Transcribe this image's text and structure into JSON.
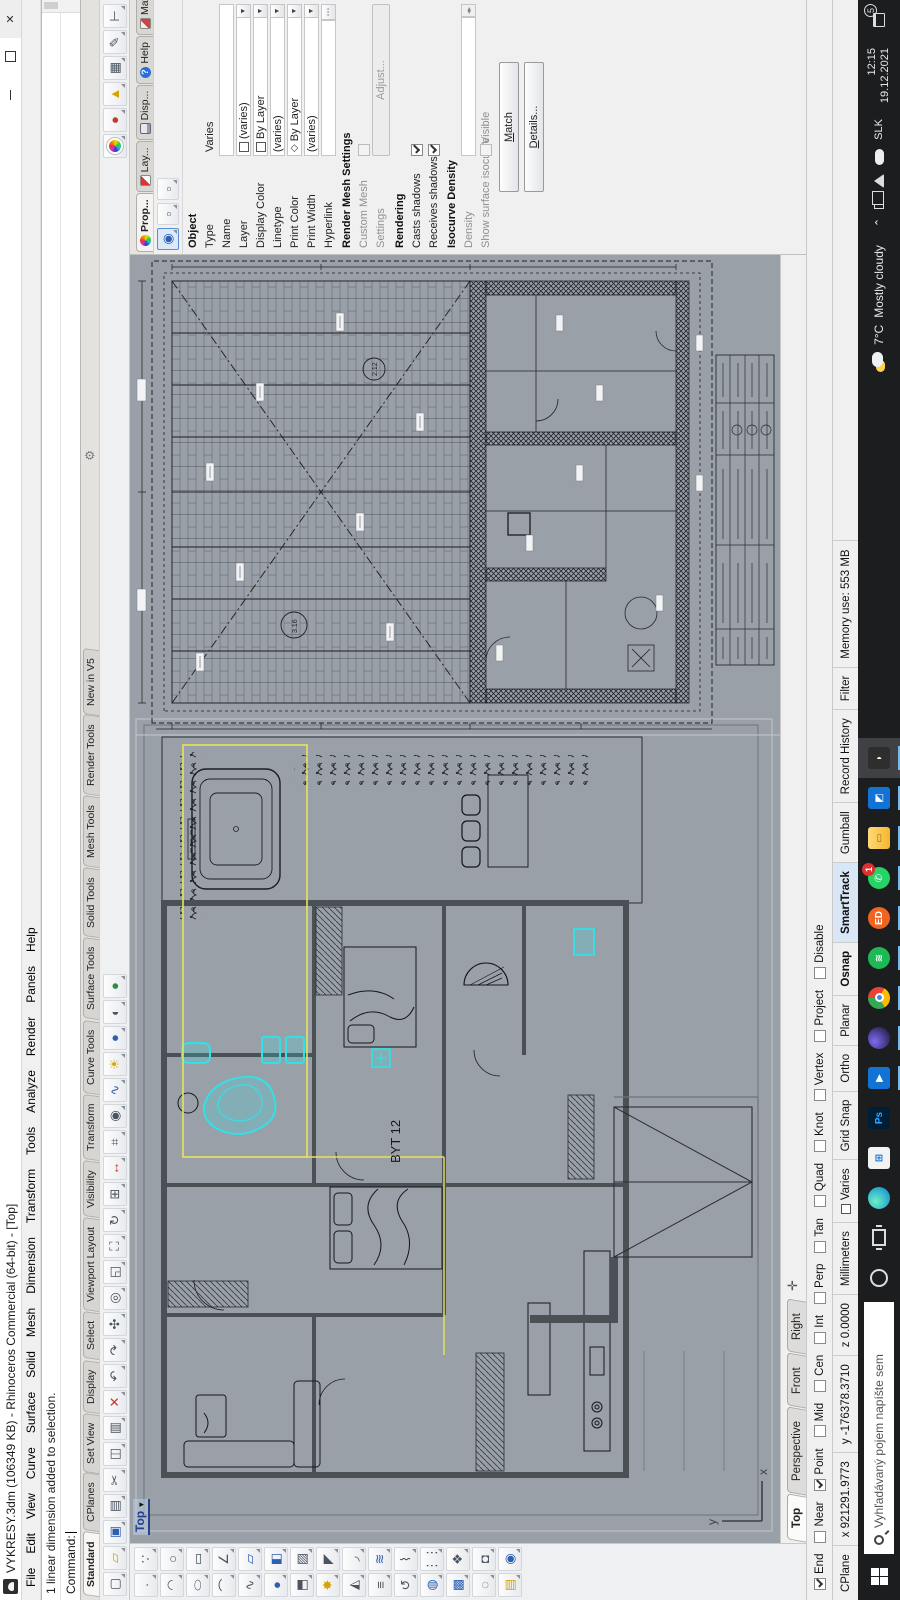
{
  "window": {
    "title": "VYKRESY.3dm (106349 KB) - Rhinoceros Commercial (64-bit) - [Top]",
    "controls": {
      "minimize": "minimize",
      "maximize": "maximize",
      "close": "close"
    }
  },
  "menu": [
    "File",
    "Edit",
    "View",
    "Curve",
    "Surface",
    "Solid",
    "Mesh",
    "Dimension",
    "Transform",
    "Tools",
    "Analyze",
    "Render",
    "Panels",
    "Help"
  ],
  "command": {
    "history": "1 linear dimension added to selection.",
    "prompt": "Command:"
  },
  "toolbar_tabs": {
    "active": "Standard",
    "items": [
      "Standard",
      "CPlanes",
      "Set View",
      "Display",
      "Select",
      "Viewport Layout",
      "Visibility",
      "Transform",
      "Curve Tools",
      "Surface Tools",
      "Solid Tools",
      "Mesh Tools",
      "Render Tools",
      "New in V5"
    ]
  },
  "toolbar_icons_left": [
    "new-file-icon",
    "open-file-icon",
    "save-icon",
    "print-icon",
    "cut-icon",
    "copy-icon",
    "paste-icon",
    "delete-icon",
    "undo-icon",
    "redo-icon",
    "pan-icon",
    "zoom-dynamic-icon",
    "zoom-window-icon",
    "zoom-extents-icon",
    "rotate-view-icon",
    "viewport-layout-icon",
    "move-icon",
    "cplane-icon",
    "osnap-icon",
    "analyze-icon",
    "light-icon",
    "shaded-view-icon",
    "ghosted-view-icon",
    "rendered-view-icon"
  ],
  "toolbar_icons_right": [
    "color-wheel-icon",
    "render-sphere-icon",
    "spotlight-icon",
    "grid-annotate-icon",
    "page-annotate-icon",
    "dimension-annotate-icon"
  ],
  "side_toolbar_icons": [
    "point-icon",
    "control-points-icon",
    "curve-icon",
    "circle-icon",
    "ellipse-icon",
    "rectangle-icon",
    "arc-icon",
    "polyline-icon",
    "freeform-curve-icon",
    "surface-icon",
    "sphere-icon",
    "box-icon",
    "extrude-icon",
    "patch-icon",
    "explode-icon",
    "trim-icon",
    "split-icon",
    "fillet-icon",
    "offset-icon",
    "loft-icon",
    "revolve-icon",
    "sweep-icon",
    "boolean-icon",
    "array-icon",
    "block-icon",
    "group-icon",
    "hide-icon",
    "lock-icon",
    "layer-state-icon",
    "object-properties-icon"
  ],
  "viewport": {
    "label": "Top",
    "axis_x": "x",
    "axis_y": "y",
    "plan_label": "BYT 12",
    "room_labels": [
      "3.16",
      "2.12"
    ]
  },
  "viewport_tabs": {
    "active": "Top",
    "items": [
      "Top",
      "Perspective",
      "Front",
      "Right"
    ],
    "add_button": "new-viewport-tab"
  },
  "properties_panel": {
    "active_tab": "Prop...",
    "tabs": [
      {
        "label": "Prop...",
        "icon": "color-wheel-icon"
      },
      {
        "label": "Lay...",
        "icon": "layers-icon"
      },
      {
        "label": "Disp...",
        "icon": "display-icon"
      },
      {
        "label": "Help",
        "icon": "help-icon"
      },
      {
        "label": "Mat...",
        "icon": "material-icon"
      }
    ],
    "subtoolbar": [
      "object-properties-icon",
      "material-icon",
      "dimension-style-icon"
    ],
    "groups": [
      {
        "header": "Object",
        "rows": [
          {
            "label": "Type",
            "value": "Varies",
            "kind": "text"
          },
          {
            "label": "Name",
            "value": "",
            "kind": "field"
          },
          {
            "label": "Layer",
            "value": "(varies)",
            "kind": "combo",
            "swatch": true
          },
          {
            "label": "Display Color",
            "value": "By Layer",
            "kind": "combo",
            "swatch": true
          },
          {
            "label": "Linetype",
            "value": "(varies)",
            "kind": "combo"
          },
          {
            "label": "Print Color",
            "value": "By Layer",
            "kind": "combo",
            "diamond": true
          },
          {
            "label": "Print Width",
            "value": "(varies)",
            "kind": "combo"
          },
          {
            "label": "Hyperlink",
            "value": "",
            "kind": "dots"
          }
        ]
      },
      {
        "header": "Render Mesh Settings",
        "rows": [
          {
            "label": "Custom Mesh",
            "kind": "checkbox",
            "checked": false,
            "disabled": true
          },
          {
            "label": "Settings",
            "kind": "button",
            "button": "Adjust...",
            "disabled": true
          }
        ]
      },
      {
        "header": "Rendering",
        "rows": [
          {
            "label": "Casts shadows",
            "kind": "checkbox",
            "checked": true
          },
          {
            "label": "Receives shadows",
            "kind": "checkbox",
            "checked": true
          }
        ]
      },
      {
        "header": "Isocurve Density",
        "rows": [
          {
            "label": "Density",
            "value": "",
            "kind": "spinner",
            "disabled": true
          },
          {
            "label": "Show surface isocurve",
            "value": "Visible",
            "kind": "checkbox2",
            "checked": false,
            "disabled": true
          }
        ]
      }
    ],
    "buttons": [
      "Match",
      "Details..."
    ]
  },
  "osnap": {
    "items": [
      {
        "label": "End",
        "checked": true
      },
      {
        "label": "Near",
        "checked": false
      },
      {
        "label": "Point",
        "checked": true
      },
      {
        "label": "Mid",
        "checked": false
      },
      {
        "label": "Cen",
        "checked": false
      },
      {
        "label": "Int",
        "checked": false
      },
      {
        "label": "Perp",
        "checked": false
      },
      {
        "label": "Tan",
        "checked": false
      },
      {
        "label": "Quad",
        "checked": false
      },
      {
        "label": "Knot",
        "checked": false
      },
      {
        "label": "Vertex",
        "checked": false
      },
      {
        "label": "Project",
        "checked": false
      },
      {
        "label": "Disable",
        "checked": false
      }
    ]
  },
  "statusbar": {
    "panes": [
      {
        "label": "CPlane"
      },
      {
        "label": "x 921291.9773"
      },
      {
        "label": "y -176378.3710"
      },
      {
        "label": "z 0.0000"
      },
      {
        "label": "Millimeters"
      },
      {
        "label": "Varies",
        "swatch": true
      },
      {
        "label": "Grid Snap"
      },
      {
        "label": "Ortho"
      },
      {
        "label": "Planar"
      },
      {
        "label": "Osnap",
        "bold": true
      },
      {
        "label": "SmartTrack",
        "bold": true,
        "highlight": true
      },
      {
        "label": "Gumball"
      },
      {
        "label": "Record History"
      },
      {
        "label": "Filter"
      },
      {
        "label": "Memory use: 553 MB"
      }
    ]
  },
  "taskbar": {
    "search_placeholder": "Vyhľadávaný pojem napíšte sem",
    "apps": [
      {
        "name": "edge-icon"
      },
      {
        "name": "store-icon"
      },
      {
        "name": "photoshop-icon",
        "label": "Ps"
      },
      {
        "name": "play-app-icon",
        "running": true
      },
      {
        "name": "sphere-app-icon",
        "running": true
      },
      {
        "name": "chrome-icon",
        "running": true
      },
      {
        "name": "spotify-icon",
        "running": true
      },
      {
        "name": "edison-mail-icon",
        "label": "ED",
        "running": true
      },
      {
        "name": "whatsapp-icon",
        "badge": "1",
        "running": true
      },
      {
        "name": "file-explorer-icon",
        "running": true
      },
      {
        "name": "photos-icon",
        "running": true
      },
      {
        "name": "rhino-icon",
        "running": true,
        "active": true
      }
    ],
    "weather": {
      "temp": "7°C",
      "condition": "Mostly cloudy"
    },
    "tray_icons": [
      "chevron-up-icon",
      "dual-display-icon",
      "signal-icon",
      "cloud-icon"
    ],
    "language": "SLK",
    "clock": {
      "time": "12:15",
      "date": "19.12.2021"
    },
    "notification_count": "5"
  }
}
